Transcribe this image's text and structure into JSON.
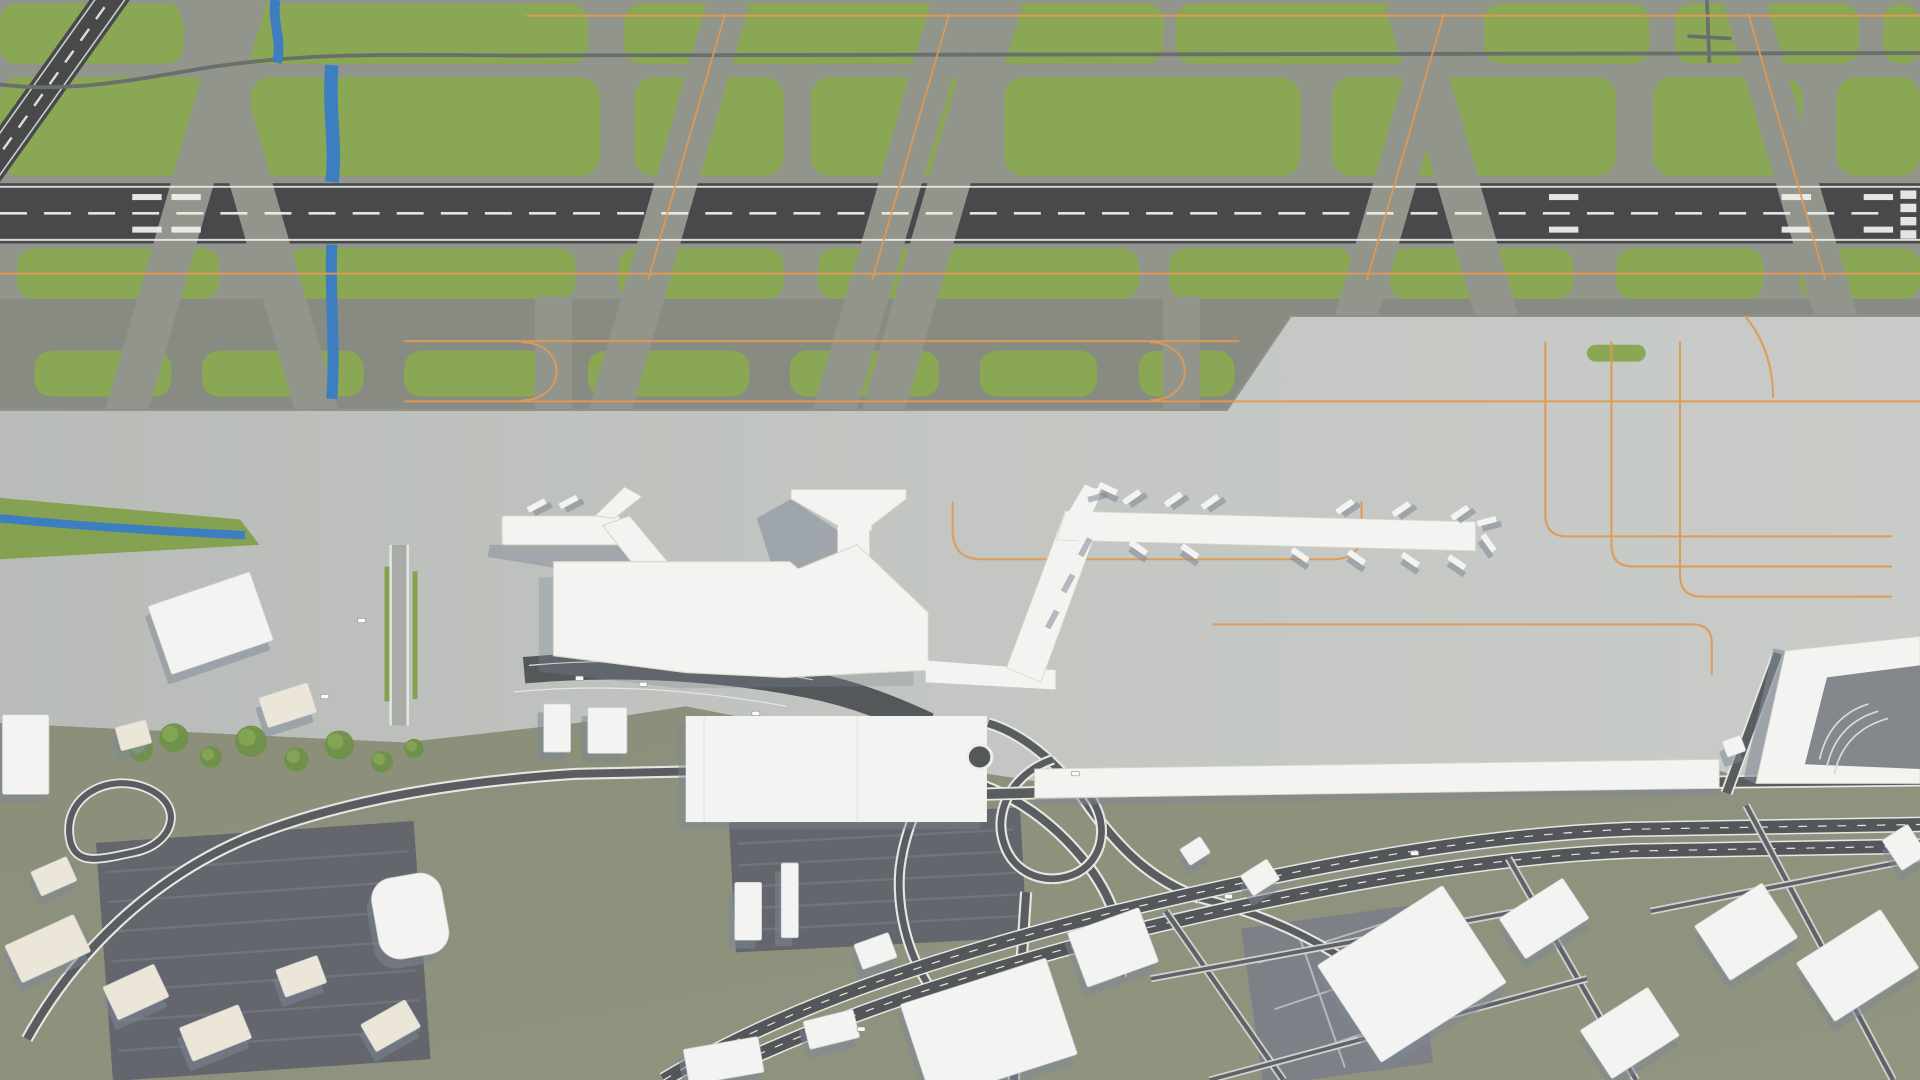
{
  "scene": {
    "title": "Aerial 3D model render of an airport: runway, taxiways, Y-shaped terminal pier, apron with orange taxi guidance lines, highway interchange and surrounding low-poly city buildings"
  },
  "palette": {
    "taxiway": "#91958c",
    "taxiway_dark": "#878b82",
    "grass": "#8aa754",
    "grass_dark": "#7d9b49",
    "runway": "#47494b",
    "runway_mark": "#eceeea",
    "apron_a": "#bdc0bc",
    "apron_b": "#c7cac6",
    "apron_seam": "#8e928a",
    "orange": "#e09a55",
    "olive": "#8e927d",
    "olive_b": "#878b76",
    "road_dark": "#5a5d60",
    "road_edge": "#e6e7e4",
    "parking": "#63666c",
    "parking_line": "#71757b",
    "building_roof": "#f3f4f1",
    "building_warm": "#ebe6d8",
    "building_shadow": "#7e8896",
    "water": "#3d7ec0",
    "tree": "#6f9147",
    "tree_light": "#87a958",
    "grid_zone": "#7d8187",
    "grid_line": "#b6bac0",
    "service_road": "#6b6f6c"
  },
  "airside": {
    "runway": {
      "y": 152,
      "h": 50,
      "centerline_y": 177,
      "dash": "22 14",
      "touchdown_xs": [
        108,
        140,
        1265,
        1455,
        1522
      ],
      "threshold": {
        "x": 1552,
        "bars": 4,
        "bar_w": 13,
        "bar_h": 7
      },
      "diagonal": {
        "x1": 98,
        "y1": -12,
        "x2": -48,
        "y2": 196,
        "w": 27
      }
    },
    "grass_rows": [
      {
        "y": 3,
        "h": 50,
        "rx": 14,
        "islands": [
          [
            0,
            150
          ],
          [
            180,
            300
          ],
          [
            510,
            260
          ],
          [
            800,
            150
          ],
          [
            960,
            230
          ],
          [
            1212,
            135
          ],
          [
            1368,
            150
          ],
          [
            1538,
            30
          ]
        ]
      },
      {
        "y": 64,
        "h": 82,
        "rx": 16,
        "islands": [
          [
            0,
            175
          ],
          [
            205,
            285
          ],
          [
            518,
            122
          ],
          [
            662,
            130
          ],
          [
            820,
            242
          ],
          [
            1088,
            232
          ],
          [
            1350,
            122
          ],
          [
            1500,
            68
          ]
        ]
      },
      {
        "y": 206,
        "h": 42,
        "rx": 14,
        "islands": [
          [
            14,
            165
          ],
          [
            235,
            235
          ],
          [
            505,
            135
          ],
          [
            668,
            262
          ],
          [
            955,
            150
          ],
          [
            1135,
            150
          ],
          [
            1320,
            120
          ],
          [
            1470,
            98
          ]
        ]
      },
      {
        "y": 291,
        "h": 38,
        "rx": 14,
        "islands": [
          [
            28,
            112
          ],
          [
            165,
            132
          ],
          [
            330,
            116
          ],
          [
            480,
            132
          ],
          [
            645,
            122
          ],
          [
            800,
            96
          ],
          [
            930,
            78
          ]
        ]
      }
    ],
    "apron_island": [
      1296,
      286,
      48,
      14
    ],
    "diag_taxiways": [
      {
        "x": 150,
        "d": 1
      },
      {
        "x": 212,
        "d": -1
      },
      {
        "x": 545,
        "d": 1
      },
      {
        "x": 728,
        "d": 1
      },
      {
        "x": 768,
        "d": 1
      },
      {
        "x": 1132,
        "d": 1
      },
      {
        "x": 1198,
        "d": -1
      },
      {
        "x": 1475,
        "d": -1
      },
      {
        "x": 452,
        "d": 0,
        "y1": 246,
        "y2": 346,
        "w": 30
      },
      {
        "x": 965,
        "d": 0,
        "y1": 246,
        "y2": 346,
        "w": 30
      }
    ],
    "orange": {
      "taxi_lines": [
        [
          13,
          430,
          1568
        ],
        [
          227,
          0,
          1568
        ],
        [
          283,
          330,
          1012
        ],
        [
          333,
          330,
          1568
        ]
      ],
      "cross_xs": [
        {
          "x": 545,
          "d": 1
        },
        {
          "x": 728,
          "d": 1
        },
        {
          "x": 1132,
          "d": 1
        },
        {
          "x": 1475,
          "d": -1
        }
      ],
      "uturn_xs": [
        452,
        965
      ]
    }
  },
  "jet_bridges": [
    [
      916,
      410,
      -35
    ],
    [
      950,
      412,
      -35
    ],
    [
      980,
      414,
      -35
    ],
    [
      1090,
      418,
      -35
    ],
    [
      1136,
      420,
      -35
    ],
    [
      1184,
      423,
      -35
    ],
    [
      922,
      452,
      35
    ],
    [
      964,
      455,
      35
    ],
    [
      1054,
      458,
      35
    ],
    [
      1100,
      460,
      35
    ],
    [
      1144,
      462,
      35
    ],
    [
      1182,
      464,
      35
    ],
    [
      1206,
      430,
      -15
    ],
    [
      1208,
      448,
      55
    ],
    [
      845,
      512,
      -62
    ],
    [
      858,
      482,
      -62
    ],
    [
      872,
      452,
      -62
    ],
    [
      884,
      406,
      -15
    ],
    [
      897,
      403,
      25
    ],
    [
      430,
      417,
      -28
    ],
    [
      456,
      414,
      -28
    ]
  ],
  "buildings": [
    {
      "x": 128,
      "y": 487,
      "w": 88,
      "h": 60,
      "r": -19
    },
    {
      "x": 2,
      "y": 593,
      "w": 38,
      "h": 66,
      "r": 0
    },
    {
      "x": 96,
      "y": 600,
      "w": 26,
      "h": 20,
      "r": -15,
      "warm": true
    },
    {
      "x": 214,
      "y": 572,
      "w": 42,
      "h": 26,
      "r": -18,
      "warm": true
    },
    {
      "x": 444,
      "y": 584,
      "w": 22,
      "h": 40,
      "r": 0
    },
    {
      "x": 480,
      "y": 587,
      "w": 32,
      "h": 38,
      "r": 0
    },
    {
      "x": 8,
      "y": 770,
      "w": 62,
      "h": 34,
      "r": -25,
      "warm": true
    },
    {
      "x": 88,
      "y": 808,
      "w": 46,
      "h": 30,
      "r": -25,
      "warm": true
    },
    {
      "x": 150,
      "y": 842,
      "w": 52,
      "h": 30,
      "r": -22,
      "warm": true
    },
    {
      "x": 228,
      "y": 798,
      "w": 36,
      "h": 24,
      "r": -20,
      "warm": true
    },
    {
      "x": 298,
      "y": 838,
      "w": 42,
      "h": 26,
      "r": -30,
      "warm": true
    },
    {
      "x": 28,
      "y": 716,
      "w": 32,
      "h": 22,
      "r": -24,
      "warm": true
    },
    {
      "x": 306,
      "y": 726,
      "w": 58,
      "h": 68,
      "r": -10,
      "rx": 18
    },
    {
      "x": 560,
      "y": 865,
      "w": 62,
      "h": 30,
      "r": -10
    },
    {
      "x": 658,
      "y": 842,
      "w": 42,
      "h": 24,
      "r": -14
    },
    {
      "x": 600,
      "y": 732,
      "w": 22,
      "h": 48,
      "r": 0
    },
    {
      "x": 638,
      "y": 716,
      "w": 14,
      "h": 62,
      "r": 0
    },
    {
      "x": 700,
      "y": 778,
      "w": 30,
      "h": 22,
      "r": -20
    },
    {
      "x": 745,
      "y": 812,
      "w": 125,
      "h": 84,
      "r": -18
    },
    {
      "x": 878,
      "y": 762,
      "w": 62,
      "h": 48,
      "r": -20
    },
    {
      "x": 966,
      "y": 698,
      "w": 20,
      "h": 16,
      "r": -33
    },
    {
      "x": 1016,
      "y": 718,
      "w": 26,
      "h": 20,
      "r": -33
    },
    {
      "x": 1092,
      "y": 760,
      "w": 122,
      "h": 96,
      "r": -33
    },
    {
      "x": 1230,
      "y": 742,
      "w": 62,
      "h": 40,
      "r": -33
    },
    {
      "x": 1298,
      "y": 833,
      "w": 66,
      "h": 48,
      "r": -33
    },
    {
      "x": 1393,
      "y": 746,
      "w": 66,
      "h": 54,
      "r": -33
    },
    {
      "x": 1476,
      "y": 772,
      "w": 82,
      "h": 58,
      "r": -33
    },
    {
      "x": 1543,
      "y": 688,
      "w": 25,
      "h": 30,
      "r": -33
    },
    {
      "x": 1408,
      "y": 612,
      "w": 16,
      "h": 14,
      "r": -20
    }
  ],
  "parking_lots": [
    {
      "x": 85,
      "y": 690,
      "w": 260,
      "h": 198,
      "r": -4,
      "rows": 7
    },
    {
      "x": 598,
      "y": 676,
      "w": 238,
      "h": 108,
      "r": -3,
      "rows": 5
    }
  ],
  "trees": [
    [
      115,
      622,
      10
    ],
    [
      142,
      612,
      12
    ],
    [
      172,
      628,
      9
    ],
    [
      205,
      615,
      13
    ],
    [
      242,
      630,
      10
    ],
    [
      277,
      618,
      12
    ],
    [
      312,
      632,
      9
    ],
    [
      338,
      621,
      8
    ]
  ],
  "cars": [
    [
      262,
      576
    ],
    [
      292,
      513
    ],
    [
      522,
      566
    ],
    [
      470,
      561
    ],
    [
      700,
      852
    ],
    [
      1000,
      742
    ],
    [
      1152,
      706
    ],
    [
      614,
      590
    ],
    [
      875,
      640
    ]
  ]
}
